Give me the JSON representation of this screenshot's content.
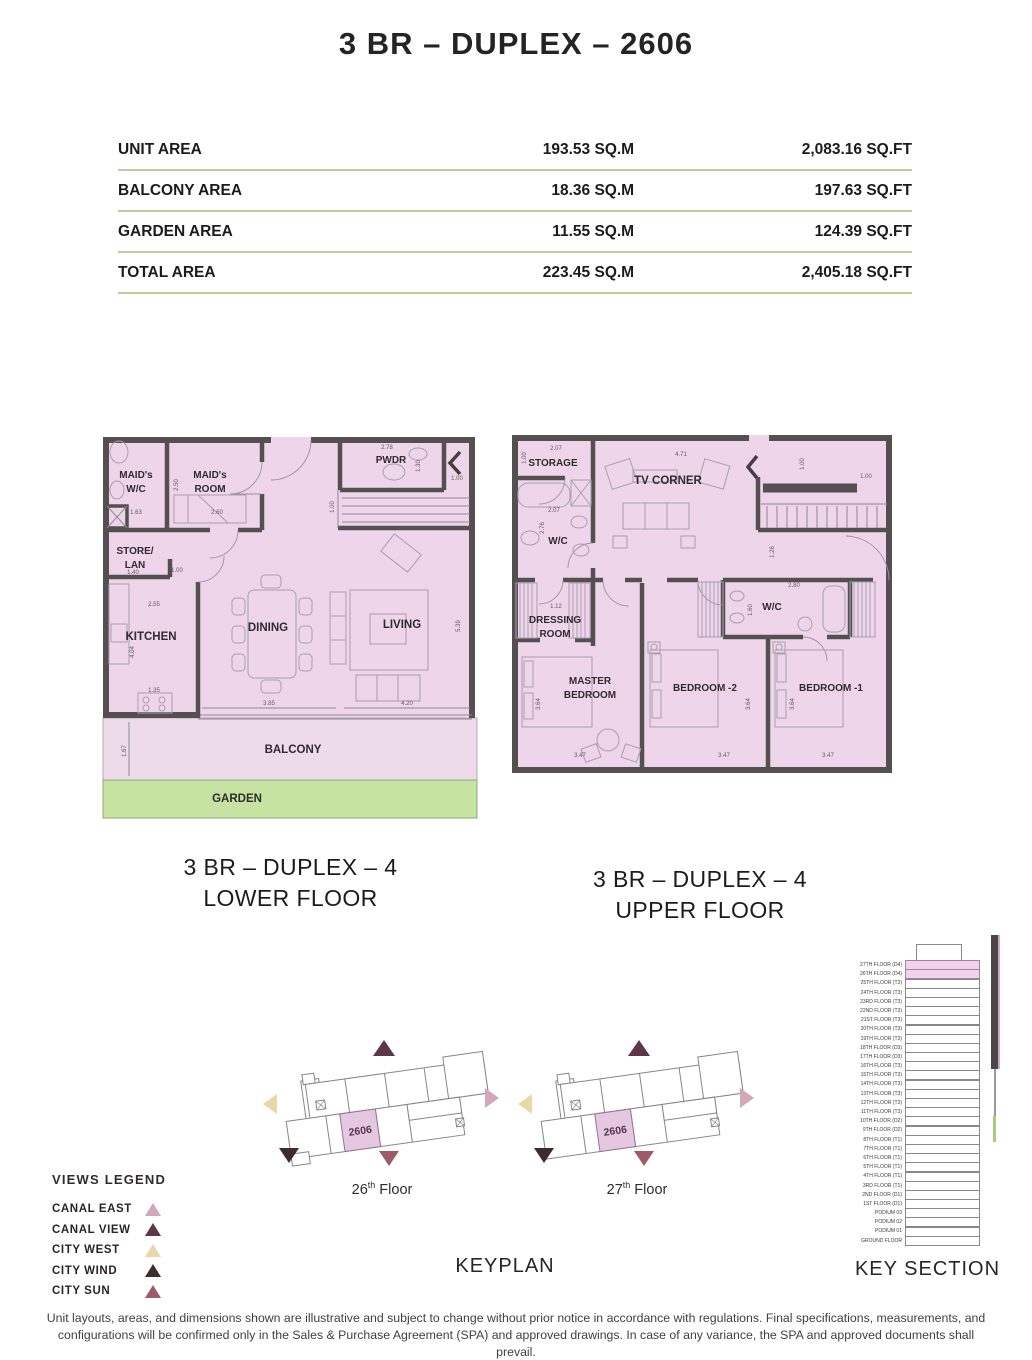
{
  "title": "3 BR – DUPLEX – 2606",
  "colors": {
    "plan_fill": "#efd5ea",
    "balcony_fill": "#eedbe9",
    "garden_fill": "#c6e3a1",
    "wall": "#555050",
    "table_line": "#cdc5a0",
    "highlight_unit": "#e5c7e0",
    "section_highlight": "#eed3ea"
  },
  "area_table": {
    "rows": [
      {
        "label": "UNIT AREA",
        "sqm": "193.53 SQ.M",
        "sqft": "2,083.16 SQ.FT"
      },
      {
        "label": "BALCONY AREA",
        "sqm": "18.36 SQ.M",
        "sqft": "197.63 SQ.FT"
      },
      {
        "label": "GARDEN AREA",
        "sqm": "11.55 SQ.M",
        "sqft": "124.39 SQ.FT"
      },
      {
        "label": "TOTAL AREA",
        "sqm": "223.45 SQ.M",
        "sqft": "2,405.18 SQ.FT"
      }
    ]
  },
  "lower_plan": {
    "caption_line1": "3 BR – DUPLEX – 4",
    "caption_line2": "LOWER FLOOR",
    "rooms": {
      "maids_wc_l1": "MAID's",
      "maids_wc_l2": "W/C",
      "maids_room_l1": "MAID's",
      "maids_room_l2": "ROOM",
      "pwdr": "PWDR",
      "store_l1": "STORE/",
      "store_l2": "LAN",
      "kitchen": "KITCHEN",
      "dining": "DINING",
      "living": "LIVING",
      "balcony": "BALCONY",
      "garden": "GARDEN"
    },
    "dims": [
      "2.78",
      "1.30",
      "1.00",
      "2.50",
      "1.63",
      "2.60",
      "1.00",
      "1.40",
      "1.00",
      "2.55",
      "4.04",
      "1.35",
      "3.85",
      "4.20",
      "5.39",
      "1.67"
    ]
  },
  "upper_plan": {
    "caption_line1": "3 BR – DUPLEX – 4",
    "caption_line2": "UPPER FLOOR",
    "rooms": {
      "storage": "STORAGE",
      "tv_corner": "TV CORNER",
      "wc_master": "W/C",
      "dressing_l1": "DRESSING",
      "dressing_l2": "ROOM",
      "master_l1": "MASTER",
      "master_l2": "BEDROOM",
      "bedroom2": "BEDROOM -2",
      "wc_shared": "W/C",
      "bedroom1": "BEDROOM -1"
    },
    "dims": [
      "2.07",
      "1.00",
      "4.71",
      "1.00",
      "1.00",
      "2.07",
      "2.76",
      "1.12",
      "1.26",
      "2.80",
      "1.60",
      "3.64",
      "3.64",
      "3.64",
      "3.47",
      "3.47",
      "3.47"
    ]
  },
  "keyplan": {
    "label": "KEYPLAN",
    "unit": "2606",
    "floors": [
      {
        "num": "26",
        "sup": "th",
        "rest": " Floor"
      },
      {
        "num": "27",
        "sup": "th",
        "rest": " Floor"
      }
    ]
  },
  "key_section": {
    "label": "KEY SECTION",
    "floors": [
      "27TH FLOOR (D4)",
      "26TH FLOOR (D4)",
      "25TH FLOOR (T3)",
      "24TH FLOOR (T3)",
      "23RD FLOOR (T3)",
      "22ND FLOOR (T3)",
      "21ST FLOOR (T3)",
      "20TH FLOOR (T3)",
      "19TH FLOOR (T3)",
      "18TH FLOOR (D3)",
      "17TH FLOOR (D3)",
      "16TH FLOOR (T3)",
      "15TH FLOOR (T3)",
      "14TH FLOOR (T3)",
      "13TH FLOOR (T3)",
      "12TH FLOOR (T3)",
      "11TH FLOOR (T3)",
      "10TH FLOOR (D2)",
      "9TH FLOOR (D2)",
      "8TH FLOOR (T1)",
      "7TH FLOOR (T1)",
      "6TH FLOOR (T1)",
      "5TH FLOOR (T1)",
      "4TH FLOOR (T1)",
      "3RD FLOOR (T1)",
      "2ND FLOOR (D1)",
      "1ST FLOOR (D1)",
      "PODIUM 03",
      "PODIUM 02",
      "PODIUM 01",
      "GROUND FLOOR"
    ]
  },
  "views_legend": {
    "heading": "VIEWS LEGEND",
    "items": [
      {
        "label": "CANAL EAST",
        "color": "#d2a7ba"
      },
      {
        "label": "CANAL VIEW",
        "color": "#5d3647"
      },
      {
        "label": "CITY WEST",
        "color": "#e6d8ab"
      },
      {
        "label": "CITY WIND",
        "color": "#3b2d2a"
      },
      {
        "label": "CITY SUN",
        "color": "#9d5a68"
      }
    ]
  },
  "disclaimer": "Unit layouts, areas, and dimensions shown are illustrative and subject to change without prior notice in accordance with regulations. Final specifications, measurements, and configurations will be confirmed only in the Sales & Purchase Agreement (SPA) and approved drawings. In case of any variance, the SPA and approved documents shall prevail."
}
